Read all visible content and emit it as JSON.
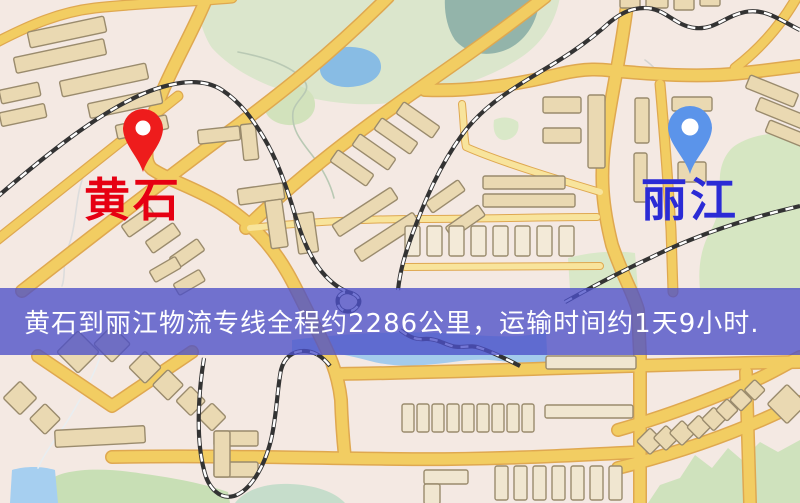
{
  "map": {
    "origin": {
      "name": "黄石",
      "label_color": "#e60012",
      "marker_color": "#ee1c1c"
    },
    "destination": {
      "name": "丽江",
      "label_color": "#2b2bd5",
      "marker_color": "#5b94ea"
    },
    "banner": {
      "text": "黄石到丽江物流专线全程约2286公里，运输时间约1天9小时.",
      "bg_color": "rgba(76,80,200,0.78)",
      "text_color": "#ffffff"
    },
    "route_summary": {
      "distance_km": "2286",
      "duration": "1天9小时"
    },
    "palette": {
      "background": "#f4e9e3",
      "road_primary": "#f2cd62",
      "road_casing": "#dfa850",
      "road_secondary": "#f8e49c",
      "building": "#ead9b2",
      "building_stroke": "#9a8b6d",
      "green_area": "#d8e6c4",
      "water": "#9ac4e8",
      "railway": "#333333"
    }
  }
}
